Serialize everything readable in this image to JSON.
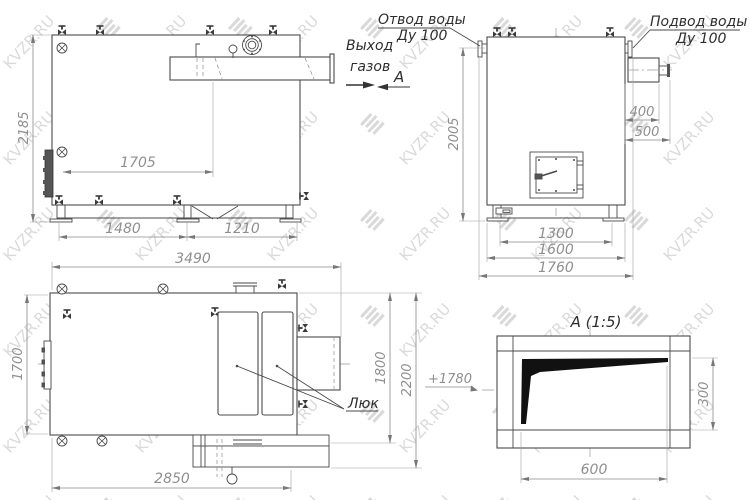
{
  "watermark": {
    "text": "KVZR.RU"
  },
  "drawing": {
    "side": {
      "height": "2185",
      "inner_width": "1705",
      "span1": "1480",
      "span2": "1210",
      "gas1": "Выход",
      "gas2": "газов",
      "view": "А"
    },
    "front": {
      "height": "2005",
      "duct1": "400",
      "duct2": "500",
      "base1": "1300",
      "base2": "1600",
      "base3": "1760",
      "outlet1": "Отвод воды",
      "outlet2": "Ду 100",
      "inlet1": "Подвод воды",
      "inlet2": "Ду 100"
    },
    "plan": {
      "length": "3490",
      "width": "1700",
      "bottom": "2850",
      "r1": "1800",
      "r2": "2200",
      "hatch": "Люк"
    },
    "detail": {
      "title": "А (1:5)",
      "w": "600",
      "h": "300",
      "level": "+1780"
    }
  }
}
